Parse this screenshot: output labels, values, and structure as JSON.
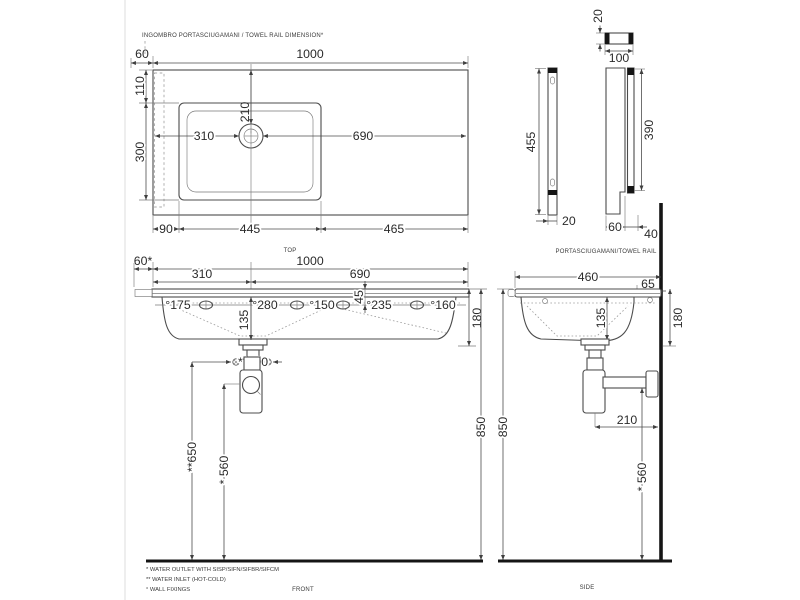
{
  "meta": {
    "background": "#ffffff",
    "ink_color": "#4c4c4c",
    "heavy_color": "#151515"
  },
  "notes": {
    "towel_dimension_note": "INGOMBRO PORTASCIUGAMANI / TOWEL RAIL DIMENSION*",
    "towel_rail_label": "PORTASCIUGAMANI/TOWEL RAIL"
  },
  "view_labels": {
    "top": "TOP",
    "front": "FRONT",
    "side": "SIDE"
  },
  "footnotes": [
    "*  WATER OUTLET WITH SISP/SIFN/SIFBR/SIFCM",
    "** WATER INLET  (HOT-COLD)",
    "° WALL FIXINGS"
  ],
  "top_view": {
    "w_rail": "60",
    "w_total": "1000",
    "d_back": "110",
    "d_bowl": "300",
    "y_drain": "210",
    "x_drain_left": "310",
    "x_drain_right": "690",
    "b_left": "90",
    "b_bowl": "445",
    "b_right": "465"
  },
  "rail_view": {
    "bar_t": "20",
    "bar_w": "100",
    "rail_h": "455",
    "rail_t": "20",
    "bracket_h": "390",
    "bracket_w": "60",
    "bracket_d": "40"
  },
  "front_view": {
    "rail_w": "60*",
    "w_total": "1000",
    "drain_cx": "310",
    "drain_cr": "690",
    "fix1": "°175",
    "fix2": "°280",
    "fix3": "°150",
    "fix4": "°235",
    "fix5": "°160",
    "fix_drop": "45",
    "drain_drop": "135",
    "edge_h": "180",
    "inlet_span": "**100",
    "inlet_h": "**650",
    "outlet_h": "* 560",
    "total_h": "850"
  },
  "side_view": {
    "depth": "460",
    "back_gap": "65",
    "drain_drop": "135",
    "edge_h": "180",
    "outlet_off": "210",
    "outlet_h": "* 560",
    "total_h": "850"
  }
}
